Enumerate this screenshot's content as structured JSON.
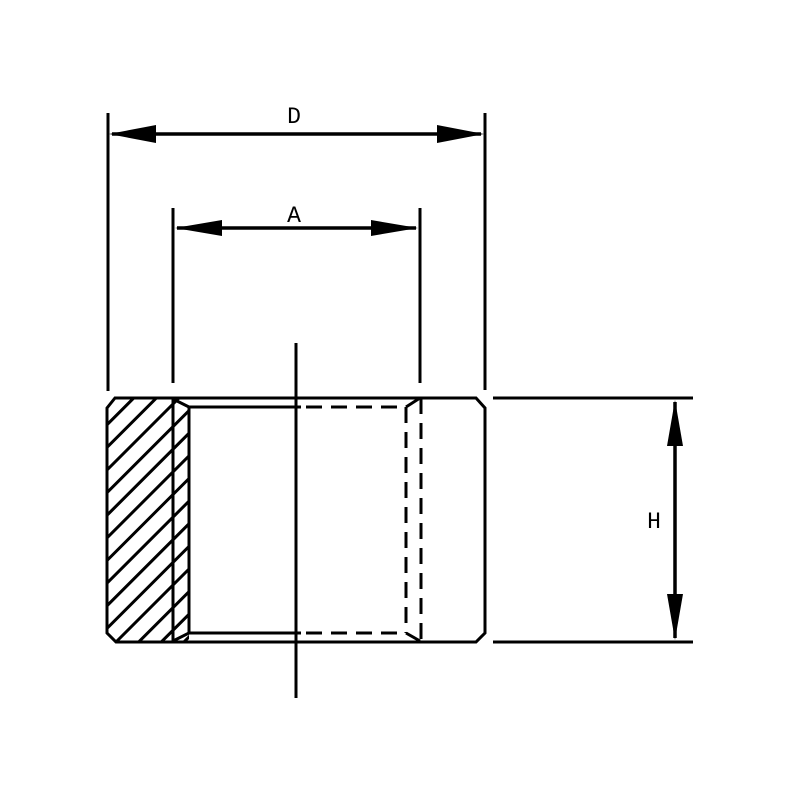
{
  "figure": {
    "kind": "engineering-dimension-drawing",
    "background_color": "#ffffff",
    "line_color": "#000000",
    "dimension_labels": {
      "outer_width": "D",
      "bore_width": "A",
      "height": "H"
    }
  }
}
